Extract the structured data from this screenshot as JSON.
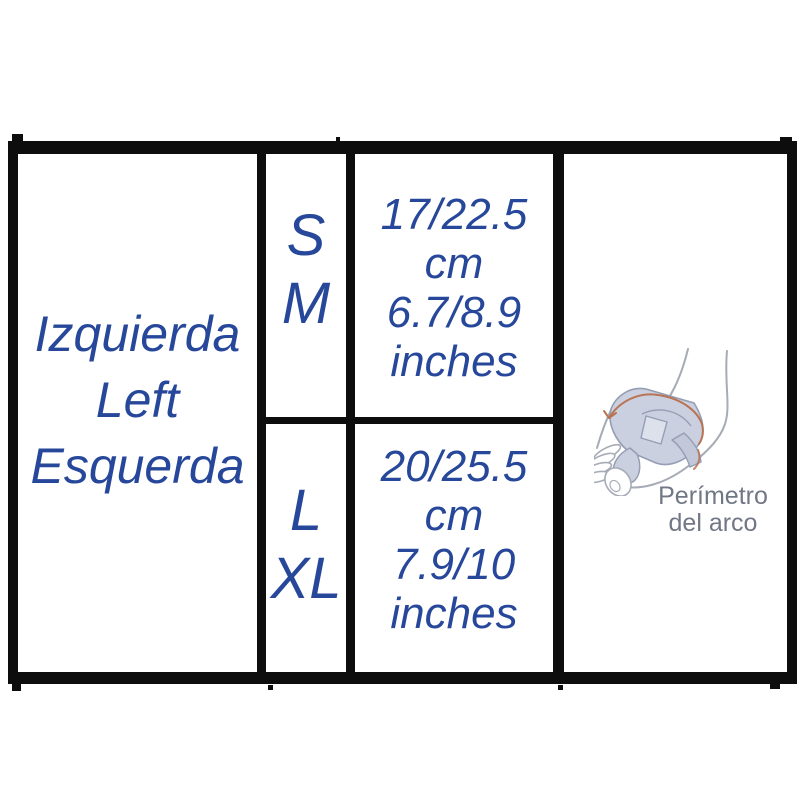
{
  "table": {
    "side_labels": [
      "Izquierda",
      "Left",
      "Esquerda"
    ],
    "rows": [
      {
        "sizes": [
          "S",
          "M"
        ],
        "measurements": [
          "17/22.5",
          "cm",
          "6.7/8.9",
          "inches"
        ]
      },
      {
        "sizes": [
          "L",
          "XL"
        ],
        "measurements": [
          "20/25.5",
          "cm",
          "7.9/10",
          "inches"
        ]
      }
    ],
    "diagram_caption": [
      "Perímetro",
      "del arco"
    ]
  },
  "colors": {
    "text_blue": "#27489a",
    "border_black": "#0d0d0d",
    "caption_gray": "#717785",
    "brace_fill": "#cad0e0",
    "brace_fill_alt": "#c2c8da",
    "brace_stroke": "#959db3",
    "foot_outline": "#a6abb6",
    "measure_orange": "#b97453"
  }
}
